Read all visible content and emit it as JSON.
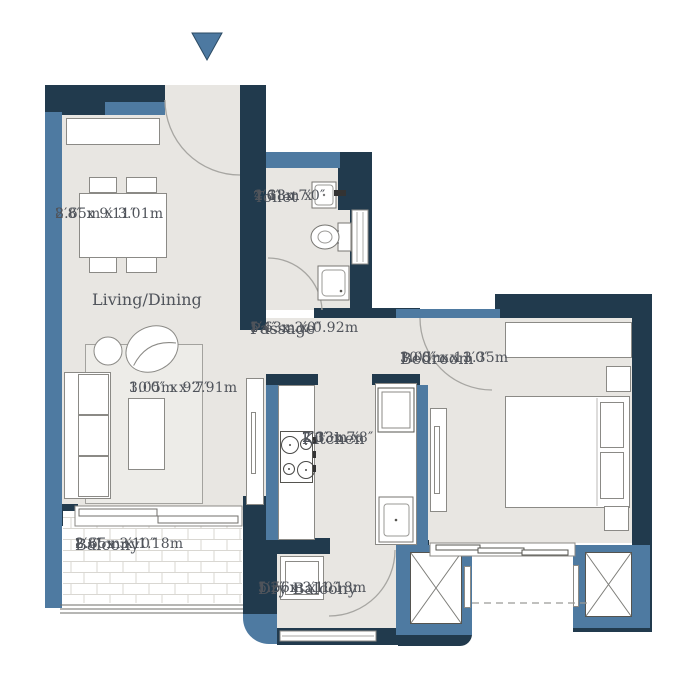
{
  "plan_type": "apartment floor plan",
  "entrance": {
    "symbol": "down-arrow"
  },
  "colors": {
    "wall_dark": "#213a4d",
    "wall_light": "#4e7aa1",
    "floor": "#e8e6e2",
    "balcony_floor": "#ffffff",
    "furniture_outline": "#8b8a86",
    "text": "#50545b",
    "entrance_arrow": "#4d79a1"
  },
  "rooms": {
    "living_dining": {
      "name": "Living/Dining",
      "dining_area": {
        "metric": "2.65m x 3.01m",
        "imperial": "8′8″ x 9′11″"
      },
      "living_area": {
        "metric": "3.05m x 2.91m",
        "imperial": "10′0″ x 9′7″"
      }
    },
    "toilet": {
      "name": "Toilet",
      "metric_line1": "1.38m x",
      "metric_line2": "2.13m",
      "imperial": "4′6″ x 7′0″"
    },
    "passage": {
      "name": "Passage",
      "metric": "1.63m x 0.92m",
      "imperial": "5′4″ x 3′0″"
    },
    "kitchen": {
      "name": "Kitchen",
      "metric_line1": "2.13m x",
      "metric_line2": "2.33m",
      "imperial": "7′0″ x 7′8″"
    },
    "bedroom": {
      "name": "Bedroom",
      "metric": "3.05m x 3.35m",
      "imperial": "10′0″ x 11′0″"
    },
    "balcony": {
      "name": "Balcony",
      "metric": "2.65m x 1.18m",
      "imperial": "8′8″ x 3′10″"
    },
    "dry_balcony": {
      "name": "Dry Balcony",
      "metric": "1.56m x 1.18m",
      "imperial": "5′2″ x 3′10″"
    }
  },
  "fixtures": [
    "entrance-arrow",
    "dining-table",
    "dining-chairs",
    "storage-cabinet",
    "sofa",
    "round-chair",
    "lounge-chair",
    "rug",
    "coffee-table",
    "tv-console",
    "wash-basin",
    "wc",
    "shower-area",
    "stove-4-burner",
    "kitchen-counter",
    "refrigerator",
    "kitchen-sink",
    "wardrobe",
    "bed",
    "pillows",
    "side-table",
    "washing-machine",
    "duct-shaft-x",
    "sliding-window",
    "balcony-railing",
    "door-swing-arc"
  ]
}
